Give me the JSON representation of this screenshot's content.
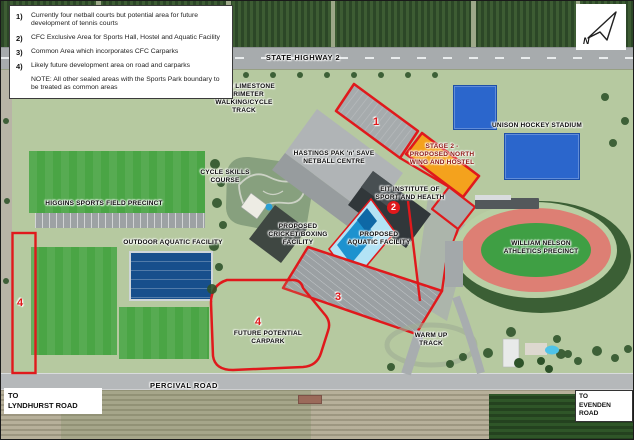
{
  "legend": {
    "items": [
      {
        "num": "1)",
        "text": "Currently four netball courts but potential area for future development of tennis courts"
      },
      {
        "num": "2)",
        "text": "CFC Exclusive Area for Sports Hall, Hostel and Aquatic Facility"
      },
      {
        "num": "3)",
        "text": "Common Area which incorporates CFC Carparks"
      },
      {
        "num": "4)",
        "text": "Likely future development area on road and carparks"
      }
    ],
    "note": "NOTE: All other sealed areas with the Sports Park boundary to be treated as common areas"
  },
  "compass": {
    "label": "N"
  },
  "labels": {
    "state_highway": "STATE HIGHWAY 2",
    "perimeter_track": [
      "2.3KM LIMESTONE",
      "PERIMETER WALKING/CYCLE",
      "TRACK"
    ],
    "unison_hockey": "UNISON HOCKEY STADIUM",
    "netball_centre": [
      "HASTINGS PAK 'n' SAVE",
      "NETBALL CENTRE"
    ],
    "cycle_skills": [
      "CYCLE SKILLS",
      "COURSE"
    ],
    "stage2": [
      "STAGE 2 -",
      "PROPOSED NORTH",
      "WING AND HOSTEL"
    ],
    "eit": [
      "EIT INSTITUTE OF",
      "SPORT AND HEALTH"
    ],
    "higgins": "HIGGINS SPORTS FIELD PRECINCT",
    "outdoor_aquatic": "OUTDOOR AQUATIC FACILITY",
    "cricket_boxing": [
      "PROPOSED",
      "CRICKET/BOXING",
      "FACILITY"
    ],
    "proposed_aquatic": [
      "PROPOSED",
      "AQUATIC FACILITY"
    ],
    "william_nelson": [
      "WILLIAM NELSON",
      "ATHLETICS PRECINCT"
    ],
    "future_carpark": [
      "FUTURE POTENTIAL",
      "CARPARK"
    ],
    "warm_up": [
      "WARM UP",
      "TRACK"
    ],
    "percival_road": "PERCIVAL ROAD",
    "to_lyndhurst": [
      "TO",
      "LYNDHURST ROAD"
    ],
    "to_evenden": [
      "TO",
      "EVENDEN ROAD"
    ]
  },
  "markers": {
    "area1": "1",
    "area2": "2",
    "area3": "3",
    "area4_road": "4",
    "area4_carpark": "4"
  },
  "colors": {
    "outline_red": "#e0191c",
    "stage2_orange": "#f4a21d",
    "stage2_text": "#8b1510",
    "proposed_aquatic_blue": "#b3e3f5",
    "pool_blue": "#1d92cf",
    "outdoor_pool_blue": "#174f8c",
    "hockey_turf_blue": "#2b66cc",
    "field_green": "#4aa545",
    "track_pink": "#dd7f74"
  }
}
